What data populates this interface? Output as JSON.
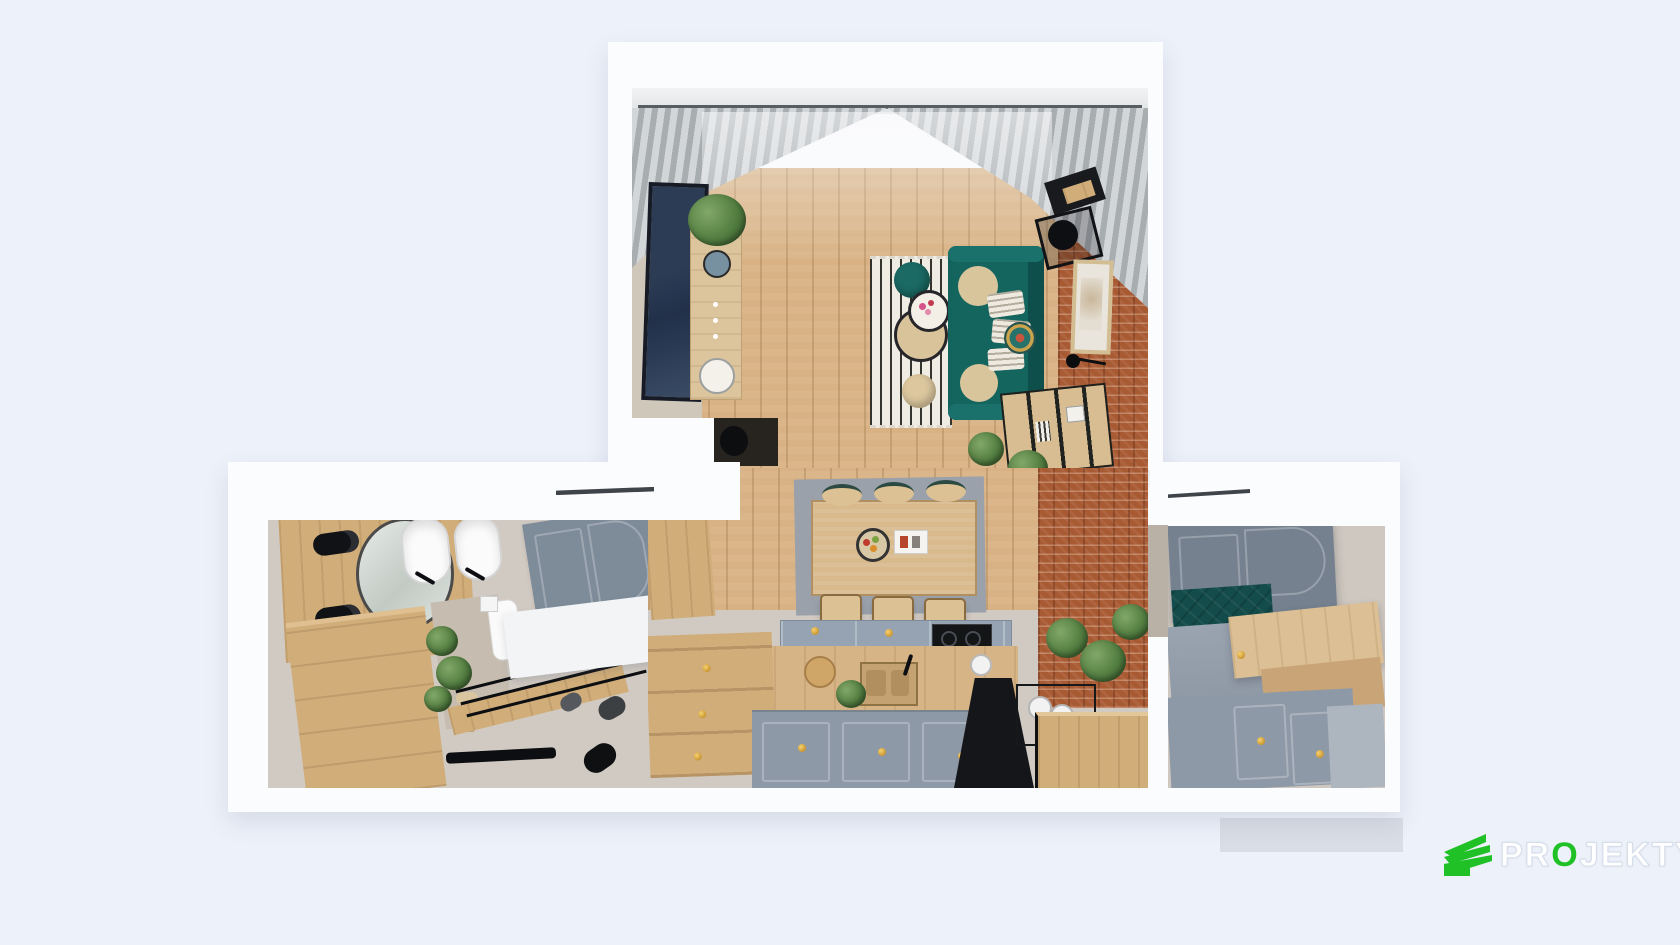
{
  "scene": {
    "title": "apartment-3d-floor-plan-top-view",
    "background_color": "#edf1f9"
  },
  "branding": {
    "logo_pre": "PR",
    "logo_o": "O",
    "logo_post": "JEKTYKA",
    "logo_green": "#1fc127"
  },
  "entry": {
    "wardrobe_handle_label": "L"
  },
  "palette": {
    "wall_white": "#fbfcfd",
    "interior_beige": "#cfc7ba",
    "wood_floor": "#d8b284",
    "brick_wall": "#a85a33",
    "sofa_teal": "#15655f",
    "bench_cushion_teal": "#134c4a",
    "cabinet_gray": "#8e99a7",
    "door_gray": "#7e8b99",
    "accent_gold": "#c9972e",
    "curtain_gray": "#a8adb0",
    "floor_tile": "#d1cac2",
    "terrace_gray": "#d9dde5"
  }
}
